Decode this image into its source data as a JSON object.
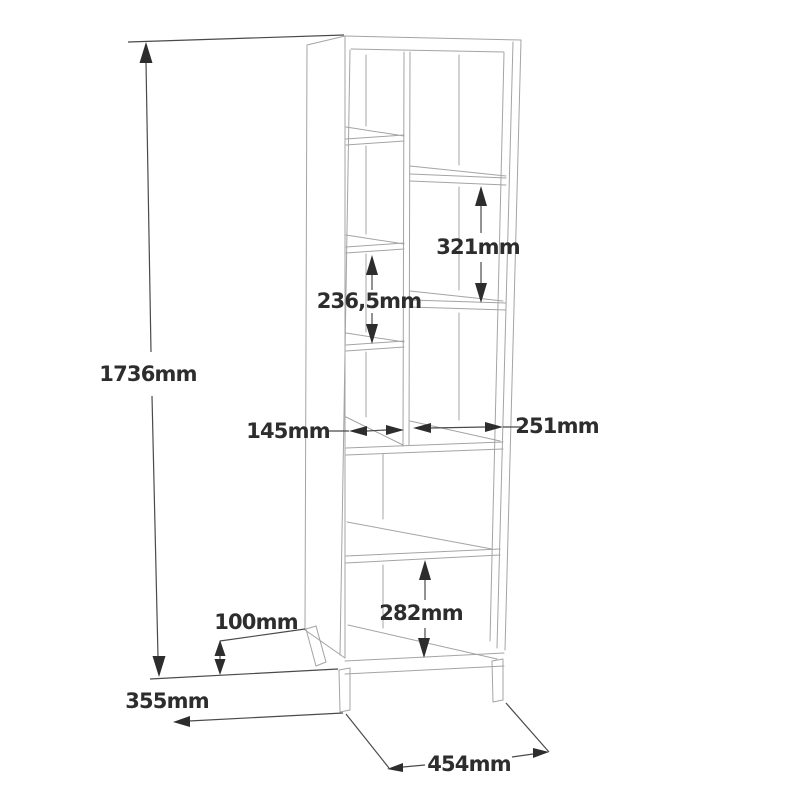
{
  "drawing": {
    "type": "furniture-dimension-drawing",
    "subject": "tall open shelving unit on legs, 3d line view",
    "unit": "mm",
    "colors": {
      "background": "#ffffff",
      "cabinet_line": "#a4a4a4",
      "dimension_line": "#4a4a4a",
      "dimension_text": "#2d2d2d"
    },
    "dimensions": {
      "height": {
        "label": "1736mm",
        "value": 1736
      },
      "right_shelf_gap": {
        "label": "321mm",
        "value": 321
      },
      "left_shelf_gap": {
        "label": "236,5mm",
        "value": 236.5
      },
      "left_column_width": {
        "label": "145mm",
        "value": 145
      },
      "right_column_width": {
        "label": "251mm",
        "value": 251
      },
      "bottom_shelf_gap": {
        "label": "282mm",
        "value": 282
      },
      "leg_height": {
        "label": "100mm",
        "value": 100
      },
      "depth": {
        "label": "355mm",
        "value": 355
      },
      "width": {
        "label": "454mm",
        "value": 454
      }
    }
  }
}
